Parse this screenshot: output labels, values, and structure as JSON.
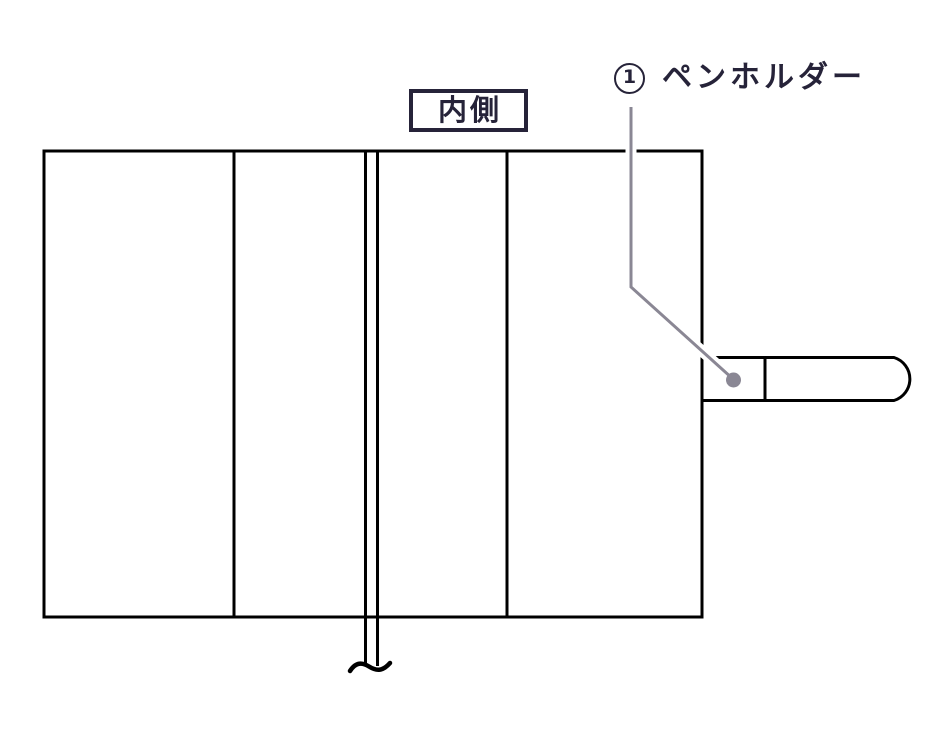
{
  "diagram": {
    "title_context": "notebook-cover-inner-side-diagram",
    "region_label": "内側",
    "callout_1": {
      "number": "1",
      "label": "ペンホルダー"
    }
  },
  "colors": {
    "background": "#FFFFFF",
    "ink": "#262339",
    "line": "#000000",
    "leader": "#8A8794"
  }
}
